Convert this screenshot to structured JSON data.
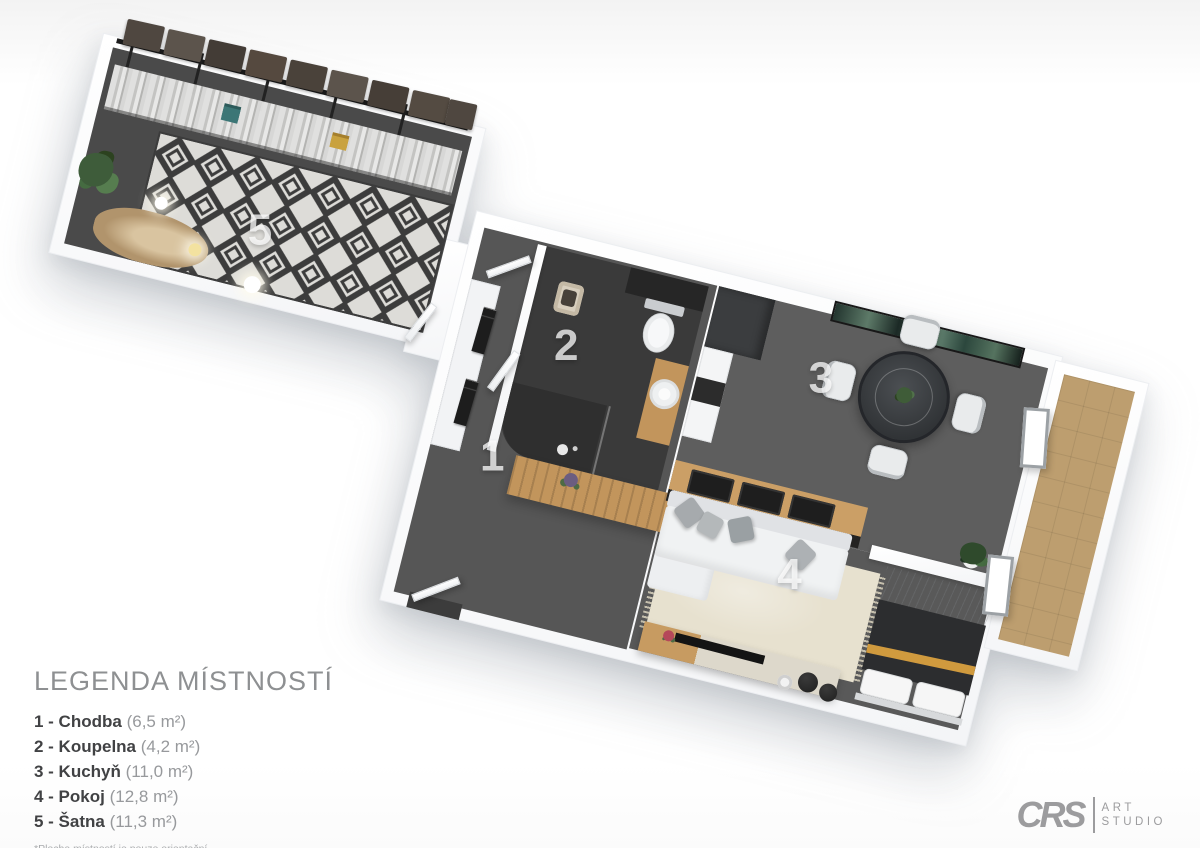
{
  "plan": {
    "labels": {
      "chodba": "1",
      "koupelna": "2",
      "kuchyn": "3",
      "pokoj": "4",
      "satna": "5"
    }
  },
  "legend": {
    "title": "LEGENDA MÍSTNOSTÍ",
    "items": [
      {
        "label": "1 - Chodba",
        "area": "(6,5 m²)"
      },
      {
        "label": "2 - Koupelna",
        "area": "(4,2 m²)"
      },
      {
        "label": "3 - Kuchyň",
        "area": "(11,0 m²)"
      },
      {
        "label": "4 - Pokoj",
        "area": "(12,8 m²)"
      },
      {
        "label": "5 - Šatna",
        "area": "(11,3 m²)"
      }
    ],
    "footnote": "*Plocha místností je pouze orientační"
  },
  "logo": {
    "brand": "CRS",
    "line1": "ART",
    "line2": "STUDIO"
  },
  "colors": {
    "floor_hall": "#565656",
    "floor_bathroom": "#3a3a3a",
    "floor_kitchen": "#5e5e5e",
    "floor_closet": "#4a4a4a",
    "rug_beige": "#e7e1cf",
    "rug_diamond": "#3c3c3c",
    "balcony_tile": "#bd9e6f",
    "wood": "#c2955c",
    "bed_gold": "#d09a3e",
    "art_green": "#5d7a68"
  }
}
